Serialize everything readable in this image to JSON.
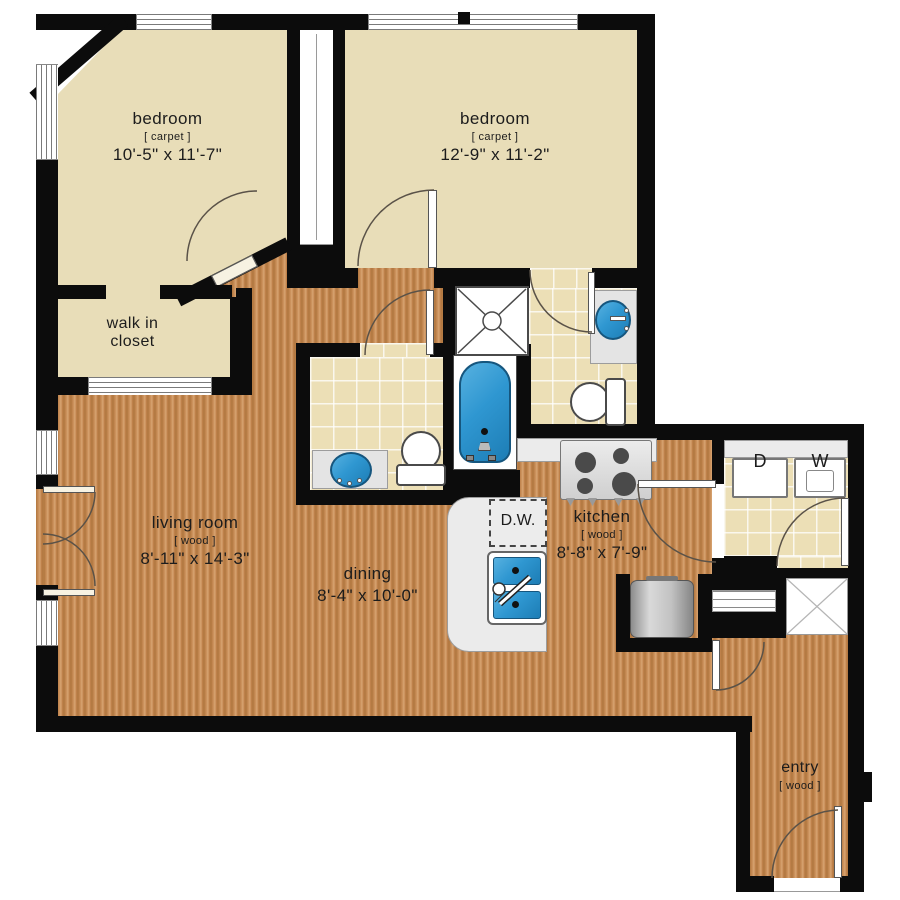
{
  "plan": {
    "rooms": {
      "bedroom_1": {
        "name": "bedroom",
        "material": "[ carpet ]",
        "dimensions": "10'-5\" x 11'-7\""
      },
      "bedroom_2": {
        "name": "bedroom",
        "material": "[ carpet ]",
        "dimensions": "12'-9\" x 11'-2\""
      },
      "walk_in_closet": {
        "line1": "walk in",
        "line2": "closet"
      },
      "living_room": {
        "name": "living room",
        "material": "[ wood ]",
        "dimensions": "8'-11\" x 14'-3\""
      },
      "dining": {
        "name": "dining",
        "dimensions": "8'-4\" x 10'-0\""
      },
      "kitchen": {
        "name": "kitchen",
        "material": "[ wood ]",
        "dimensions": "8'-8\" x 7'-9\""
      },
      "entry": {
        "name": "entry",
        "material": "[ wood ]"
      }
    },
    "appliances": {
      "dishwasher_label": "D.W.",
      "dryer_label": "D",
      "washer_label": "W"
    },
    "colors": {
      "wall": "#0c0c0c",
      "carpet": "#e8ddb8",
      "tile": "#ecdfb6",
      "wood_dark": "#b0763f",
      "wood_light": "#d8a574",
      "fixture_blue": "#2f97d1",
      "counter_gray": "#ebebeb"
    },
    "fixtures": [
      "shower",
      "bathtub",
      "toilet",
      "bathroom-sink",
      "kitchen-sink",
      "range",
      "refrigerator",
      "dishwasher",
      "washer",
      "dryer",
      "linen-shelf",
      "utility-shaft"
    ]
  }
}
